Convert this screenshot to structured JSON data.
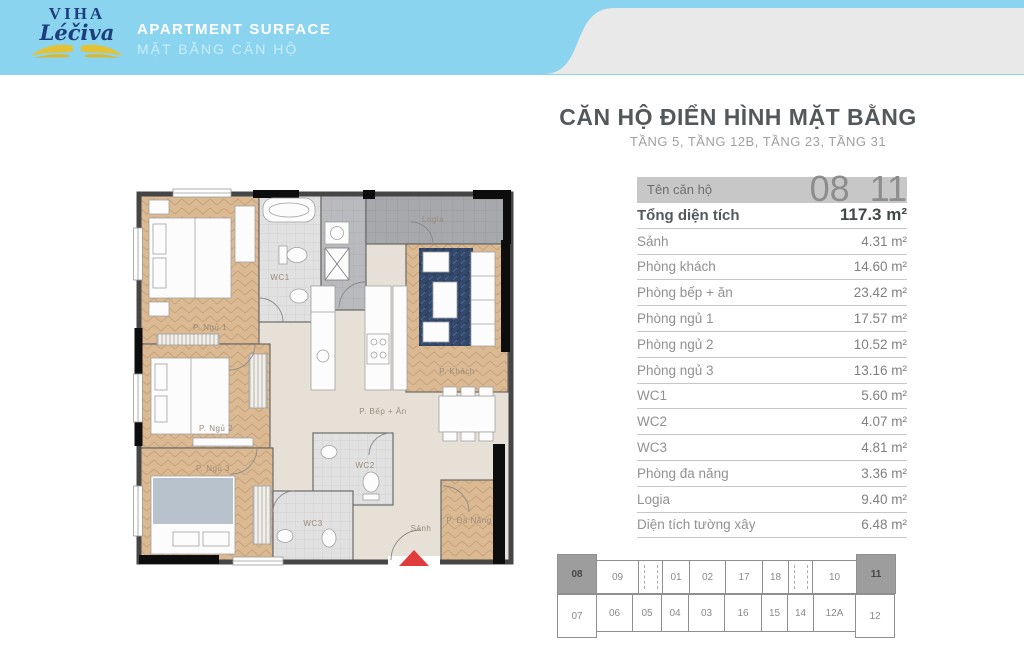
{
  "colors": {
    "banner_blue": "#8BD4F0",
    "wave_gray": "#E9E9E9",
    "unit_bar_gray": "#C7C7C7",
    "keymap_highlight": "#9D9D9D",
    "logo_navy": "#1D3E7D",
    "logo_yellow": "#E3C235",
    "entry_arrow_red": "#E03C3C",
    "wood_floor": "#DBB992",
    "wc_tile": "#E1E1E1",
    "logia_tile": "#A7A8AC"
  },
  "header": {
    "logo": {
      "line1": "VIHA",
      "line2": "Léčiva"
    },
    "title": "APARTMENT SURFACE",
    "subtitle": "MẶT BẰNG CĂN HỘ"
  },
  "info": {
    "title": "CĂN HỘ ĐIỂN HÌNH MẶT BẰNG",
    "subtitle": "TẦNG 5, TẦNG 12B, TẦNG 23, TẦNG 31",
    "unit": {
      "label": "Tên căn hộ",
      "left": "08",
      "right": "11"
    }
  },
  "table": {
    "rows": [
      {
        "label": "Tổng diện tích",
        "value": "117.3 m²"
      },
      {
        "label": "Sảnh",
        "value": "4.31 m²"
      },
      {
        "label": "Phòng khách",
        "value": "14.60 m²"
      },
      {
        "label": "Phòng bếp + ăn",
        "value": "23.42 m²"
      },
      {
        "label": "Phòng ngủ 1",
        "value": "17.57 m²"
      },
      {
        "label": "Phòng ngủ 2",
        "value": "10.52 m²"
      },
      {
        "label": "Phòng ngủ 3",
        "value": "13.16 m²"
      },
      {
        "label": "WC1",
        "value": "5.60 m²"
      },
      {
        "label": "WC2",
        "value": "4.07 m²"
      },
      {
        "label": "WC3",
        "value": "4.81 m²"
      },
      {
        "label": "Phòng đa năng",
        "value": "3.36 m²"
      },
      {
        "label": "Logia",
        "value": "9.40 m²"
      },
      {
        "label": "Diện tích tường xây",
        "value": "6.48 m²"
      }
    ]
  },
  "keymap": {
    "top": [
      {
        "label": "08",
        "highlight": true
      },
      {
        "label": "09"
      },
      {
        "label": "",
        "type": "elevator"
      },
      {
        "label": "01"
      },
      {
        "label": "02"
      },
      {
        "label": "17"
      },
      {
        "label": "18"
      },
      {
        "label": "",
        "type": "elevator"
      },
      {
        "label": "10"
      },
      {
        "label": "11",
        "highlight": true
      }
    ],
    "bottom": [
      {
        "label": "07"
      },
      {
        "label": "06"
      },
      {
        "label": "05"
      },
      {
        "label": "04"
      },
      {
        "label": "03"
      },
      {
        "label": "16"
      },
      {
        "label": "15"
      },
      {
        "label": "14"
      },
      {
        "label": "12A"
      },
      {
        "label": "12"
      }
    ]
  },
  "plan": {
    "rooms": [
      {
        "name": "bedroom-1",
        "label": "P. Ngủ 1"
      },
      {
        "name": "wc1",
        "label": "WC1"
      },
      {
        "name": "logia",
        "label": "Logia"
      },
      {
        "name": "living-room",
        "label": "P. Khách"
      },
      {
        "name": "kitchen-dining",
        "label": "P. Bếp + Ăn"
      },
      {
        "name": "bedroom-2",
        "label": "P. Ngủ 2"
      },
      {
        "name": "bedroom-3",
        "label": "P. Ngủ 3"
      },
      {
        "name": "wc2",
        "label": "WC2"
      },
      {
        "name": "wc3",
        "label": "WC3"
      },
      {
        "name": "hall",
        "label": "Sảnh"
      },
      {
        "name": "multipurpose-room",
        "label": "P. Đa Năng"
      }
    ]
  }
}
